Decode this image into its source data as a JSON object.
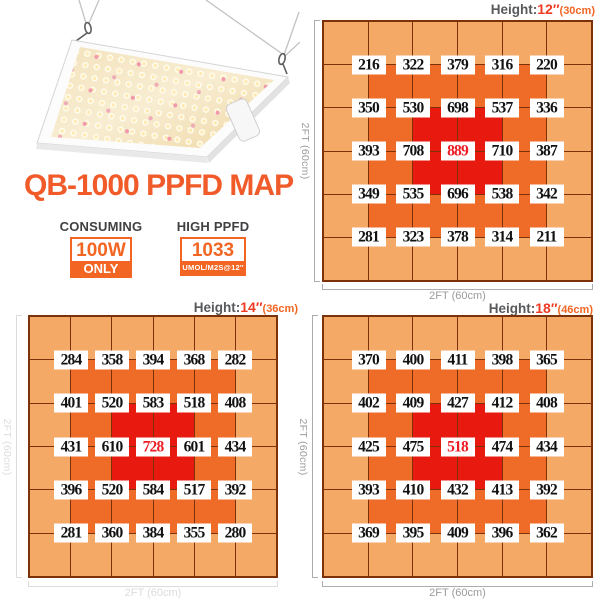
{
  "title": "QB-1000 PPFD MAP",
  "product_image": "qb-1000-led-grow-light-panel-hanging-on-wires",
  "badges": {
    "consuming": {
      "label": "CONSUMING",
      "value": "100W",
      "sub": "ONLY"
    },
    "high_ppfd": {
      "label": "HIGH PPFD",
      "value": "1033",
      "sub": "UMOL/M2S@12″"
    }
  },
  "colors": {
    "accent_orange": "#F15A29",
    "badge_orange": "#F26522",
    "heat_outer": "#F4A966",
    "heat_mid": "#EF6B28",
    "heat_core": "#E8190F",
    "grid_line": "#7C3208",
    "peak_text_red": "#ED1C24",
    "header_gray": "#58595B",
    "dim_gray": "#9B9B9B",
    "dim_faint": "#DCDCDC"
  },
  "chart_data": [
    {
      "type": "heatmap",
      "title_prefix": "Height:",
      "height_value": "12″",
      "height_cm": "(30cm)",
      "x_axis_label": "2FT (60cm)",
      "y_axis_label": "2FT (60cm)",
      "grid_layout": "6x6 cells, values shown at 5x5 interior intersections",
      "unit": "umol/m2s",
      "values": [
        [
          216,
          322,
          379,
          316,
          220
        ],
        [
          350,
          530,
          698,
          537,
          336
        ],
        [
          393,
          708,
          889,
          710,
          387
        ],
        [
          349,
          535,
          696,
          538,
          342
        ],
        [
          281,
          323,
          378,
          314,
          211
        ]
      ],
      "peak_value": 889,
      "dim_style": "normal"
    },
    {
      "type": "heatmap",
      "title_prefix": "Height:",
      "height_value": "14″",
      "height_cm": "(36cm)",
      "x_axis_label": "2FT (60cm)",
      "y_axis_label": "2FT (60cm)",
      "grid_layout": "6x6 cells, values shown at 5x5 interior intersections",
      "unit": "umol/m2s",
      "values": [
        [
          284,
          358,
          394,
          368,
          282
        ],
        [
          401,
          520,
          583,
          518,
          408
        ],
        [
          431,
          610,
          728,
          601,
          434
        ],
        [
          396,
          520,
          584,
          517,
          392
        ],
        [
          281,
          360,
          384,
          355,
          280
        ]
      ],
      "peak_value": 728,
      "dim_style": "faint"
    },
    {
      "type": "heatmap",
      "title_prefix": "Height:",
      "height_value": "18″",
      "height_cm": "(46cm)",
      "x_axis_label": "2FT (60cm)",
      "y_axis_label": "2FT (60cm)",
      "grid_layout": "6x6 cells, values shown at 5x5 interior intersections",
      "unit": "umol/m2s",
      "values": [
        [
          370,
          400,
          411,
          398,
          365
        ],
        [
          402,
          409,
          427,
          412,
          408
        ],
        [
          425,
          475,
          518,
          474,
          434
        ],
        [
          393,
          410,
          432,
          413,
          392
        ],
        [
          369,
          395,
          409,
          396,
          362
        ]
      ],
      "peak_value": 518,
      "dim_style": "normal"
    }
  ]
}
